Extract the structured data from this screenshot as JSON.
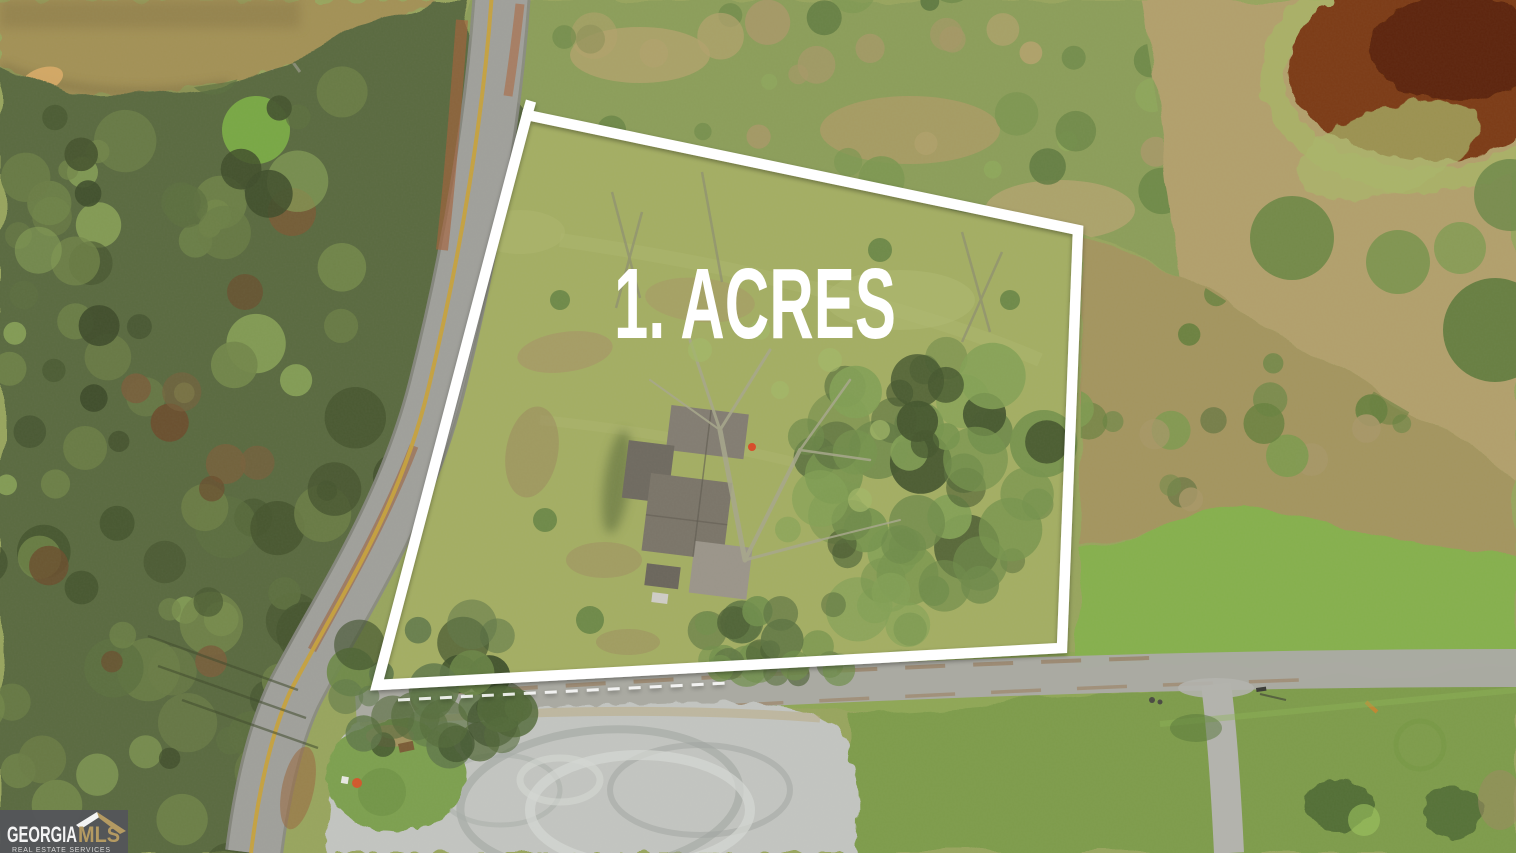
{
  "overlay": {
    "acreage_label": "1. ACRES",
    "text_color": "#ffffff",
    "boundary_color": "#ffffff"
  },
  "watermark": {
    "brand_primary": "GEORGIA",
    "brand_secondary": "MLS",
    "tagline": "REAL ESTATE SERVICES",
    "background_color": "#54555a",
    "primary_color": "#f4f4f4",
    "secondary_color": "#b49a62",
    "tagline_color": "#d9d9d9"
  },
  "scene": {
    "palette": {
      "grass": "#98a55e",
      "parcel_grass": "#a4ae64",
      "forest": "#5a6a41",
      "pond_muddy": "#a39157",
      "pond_red": "#7b3a17",
      "road_asphalt": "#a0a09b",
      "road_centerline": "#c7a23d",
      "gravel": "#c3c5c1",
      "dry_brush": "#b2a06c",
      "bright_lawn": "#86b04e",
      "roof": "#7b7569"
    }
  }
}
